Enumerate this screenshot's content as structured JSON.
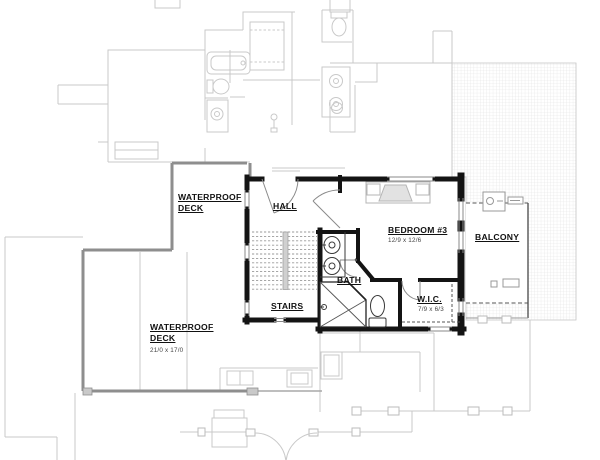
{
  "title": "Second floor plan",
  "labels": {
    "deck_upper": {
      "line1": "WATERPROOF",
      "line2": "DECK"
    },
    "hall": "HALL",
    "stairs": "STAIRS",
    "bath": "BATH",
    "bedroom": {
      "name": "BEDROOM #3",
      "dims": "12/9 x 12/6"
    },
    "wic": {
      "name": "W.I.C.",
      "dims": "7/9 x 6/3"
    },
    "balcony": "BALCONY",
    "deck_lower": {
      "line1": "WATERPROOF",
      "line2": "DECK",
      "dims": "21/0 x 17/0"
    }
  },
  "colors": {
    "wall": "#141414",
    "faint": "#c9c9c9",
    "rail": "#8e8e8e",
    "hatch_line": "#e0e0e0",
    "label": "#111111",
    "paper": "#ffffff"
  }
}
